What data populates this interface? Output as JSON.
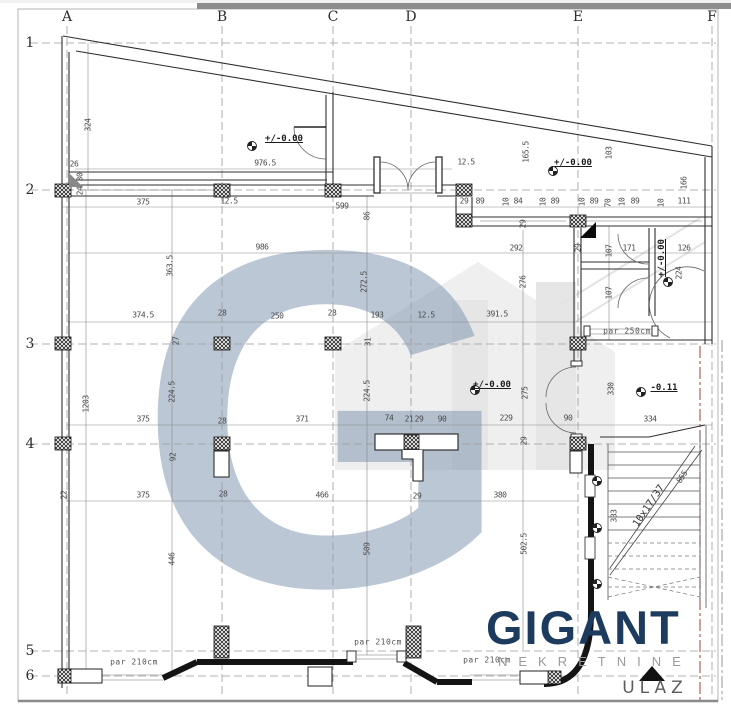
{
  "drawing": {
    "type": "architectural floor plan",
    "watermark_letter": "G",
    "colors": {
      "brand": "#1d3a5f",
      "subtitle": "#9b9b9b",
      "watermark": "#7d94af",
      "boundary_line": "#9c4536"
    }
  },
  "logo": {
    "brand": "GIGANT",
    "subtitle": "NEKRETNINE"
  },
  "grid": {
    "columns": [
      {
        "label": "A",
        "x": 67
      },
      {
        "label": "B",
        "x": 222
      },
      {
        "label": "C",
        "x": 333
      },
      {
        "label": "D",
        "x": 411
      },
      {
        "label": "E",
        "x": 578
      },
      {
        "label": "F",
        "x": 712
      }
    ],
    "rows": [
      {
        "label": "1",
        "y": 43
      },
      {
        "label": "2",
        "y": 190
      },
      {
        "label": "3",
        "y": 344
      },
      {
        "label": "4",
        "y": 444
      },
      {
        "label": "5",
        "y": 651
      },
      {
        "label": "6",
        "y": 676
      }
    ]
  },
  "labels": [
    {
      "t": "324",
      "x": 88,
      "y": 125,
      "r": -90
    },
    {
      "t": "26",
      "x": 74,
      "y": 164
    },
    {
      "t": "30",
      "x": 80,
      "y": 177,
      "r": -90
    },
    {
      "t": "24",
      "x": 80,
      "y": 191,
      "r": -90
    },
    {
      "t": "976.5",
      "x": 265,
      "y": 163
    },
    {
      "t": "+/-0.00",
      "x": 284,
      "y": 139,
      "c": "level"
    },
    {
      "t": "12.5",
      "x": 466,
      "y": 162
    },
    {
      "t": "165.5",
      "x": 526,
      "y": 152,
      "r": -90
    },
    {
      "t": "+/-0.00",
      "x": 573,
      "y": 163,
      "c": "level"
    },
    {
      "t": "103",
      "x": 609,
      "y": 153,
      "r": -90
    },
    {
      "t": "166",
      "x": 684,
      "y": 183,
      "r": -90
    },
    {
      "t": "375",
      "x": 143,
      "y": 202
    },
    {
      "t": "12.5",
      "x": 229,
      "y": 201
    },
    {
      "t": "599",
      "x": 342,
      "y": 206
    },
    {
      "t": "86",
      "x": 367,
      "y": 216,
      "r": -90
    },
    {
      "t": "29",
      "x": 464,
      "y": 201
    },
    {
      "t": "89",
      "x": 480,
      "y": 201
    },
    {
      "t": "10",
      "x": 506,
      "y": 202,
      "r": -90
    },
    {
      "t": "84",
      "x": 518,
      "y": 201
    },
    {
      "t": "10",
      "x": 543,
      "y": 202,
      "r": -90
    },
    {
      "t": "89",
      "x": 555,
      "y": 201
    },
    {
      "t": "10",
      "x": 582,
      "y": 202,
      "r": -90
    },
    {
      "t": "89",
      "x": 594,
      "y": 201
    },
    {
      "t": "70",
      "x": 608,
      "y": 203,
      "r": -90
    },
    {
      "t": "10",
      "x": 622,
      "y": 202,
      "r": -90
    },
    {
      "t": "89",
      "x": 635,
      "y": 201
    },
    {
      "t": "10",
      "x": 661,
      "y": 203,
      "r": -90
    },
    {
      "t": "111",
      "x": 684,
      "y": 201
    },
    {
      "t": "29",
      "x": 523,
      "y": 224,
      "r": -90
    },
    {
      "t": "986",
      "x": 262,
      "y": 247
    },
    {
      "t": "292",
      "x": 516,
      "y": 248
    },
    {
      "t": "29",
      "x": 578,
      "y": 248,
      "r": -90
    },
    {
      "t": "107",
      "x": 609,
      "y": 251,
      "r": -90
    },
    {
      "t": "171",
      "x": 629,
      "y": 248
    },
    {
      "t": "126",
      "x": 684,
      "y": 248
    },
    {
      "t": "+/-0.00",
      "x": 662,
      "y": 258,
      "r": -90,
      "c": "level"
    },
    {
      "t": "224",
      "x": 679,
      "y": 273,
      "r": -90
    },
    {
      "t": "107",
      "x": 609,
      "y": 293,
      "r": -90
    },
    {
      "t": "276",
      "x": 523,
      "y": 282,
      "r": -90
    },
    {
      "t": "363.5",
      "x": 170,
      "y": 266,
      "r": -90
    },
    {
      "t": "272.5",
      "x": 364,
      "y": 282,
      "r": -90
    },
    {
      "t": "374.5",
      "x": 143,
      "y": 315
    },
    {
      "t": "28",
      "x": 222,
      "y": 313
    },
    {
      "t": "250",
      "x": 277,
      "y": 316
    },
    {
      "t": "28",
      "x": 332,
      "y": 313
    },
    {
      "t": "193",
      "x": 377,
      "y": 315
    },
    {
      "t": "12.5",
      "x": 426,
      "y": 315
    },
    {
      "t": "391.5",
      "x": 497,
      "y": 314
    },
    {
      "t": "31",
      "x": 368,
      "y": 342,
      "r": -90
    },
    {
      "t": "27",
      "x": 176,
      "y": 341,
      "r": -90
    },
    {
      "t": "par 250cm",
      "x": 627,
      "y": 331,
      "c": "par"
    },
    {
      "t": "224.5",
      "x": 172,
      "y": 392,
      "r": -90
    },
    {
      "t": "224.5",
      "x": 367,
      "y": 391,
      "r": -90
    },
    {
      "t": "1203",
      "x": 86,
      "y": 404,
      "r": -90
    },
    {
      "t": "275",
      "x": 525,
      "y": 393,
      "r": -90
    },
    {
      "t": "330",
      "x": 611,
      "y": 389,
      "r": -90
    },
    {
      "t": "-0.11",
      "x": 664,
      "y": 388,
      "c": "level"
    },
    {
      "t": "+/-0.00",
      "x": 492,
      "y": 385,
      "c": "level"
    },
    {
      "t": "375",
      "x": 143,
      "y": 419
    },
    {
      "t": "371",
      "x": 302,
      "y": 419
    },
    {
      "t": "74",
      "x": 389,
      "y": 418
    },
    {
      "t": "21",
      "x": 409,
      "y": 419
    },
    {
      "t": "29",
      "x": 419,
      "y": 419
    },
    {
      "t": "90",
      "x": 442,
      "y": 419
    },
    {
      "t": "229",
      "x": 506,
      "y": 418
    },
    {
      "t": "90",
      "x": 568,
      "y": 418
    },
    {
      "t": "334",
      "x": 650,
      "y": 419
    },
    {
      "t": "28",
      "x": 222,
      "y": 421
    },
    {
      "t": "29",
      "x": 524,
      "y": 441,
      "r": -90
    },
    {
      "t": "92",
      "x": 173,
      "y": 457,
      "r": -90
    },
    {
      "t": "22",
      "x": 64,
      "y": 495,
      "r": -90
    },
    {
      "t": "375",
      "x": 143,
      "y": 495
    },
    {
      "t": "28",
      "x": 223,
      "y": 494
    },
    {
      "t": "466",
      "x": 322,
      "y": 495
    },
    {
      "t": "29",
      "x": 417,
      "y": 496
    },
    {
      "t": "380",
      "x": 500,
      "y": 495
    },
    {
      "t": "446",
      "x": 172,
      "y": 559,
      "r": -90
    },
    {
      "t": "509",
      "x": 367,
      "y": 549,
      "r": -90
    },
    {
      "t": "502.5",
      "x": 524,
      "y": 544,
      "r": -90
    },
    {
      "t": "333",
      "x": 614,
      "y": 516,
      "r": -90
    },
    {
      "t": "855",
      "x": 682,
      "y": 477,
      "r": -56
    },
    {
      "t": "10x17/37",
      "x": 649,
      "y": 506,
      "r": -56,
      "c": "stair"
    },
    {
      "t": "par 210cm",
      "x": 134,
      "y": 662,
      "c": "par"
    },
    {
      "t": "par 210cm",
      "x": 378,
      "y": 642,
      "c": "par"
    },
    {
      "t": "par 210cm",
      "x": 487,
      "y": 660,
      "c": "par"
    },
    {
      "t": "ULAZ",
      "x": 655,
      "y": 688,
      "c": "ulaz"
    }
  ]
}
